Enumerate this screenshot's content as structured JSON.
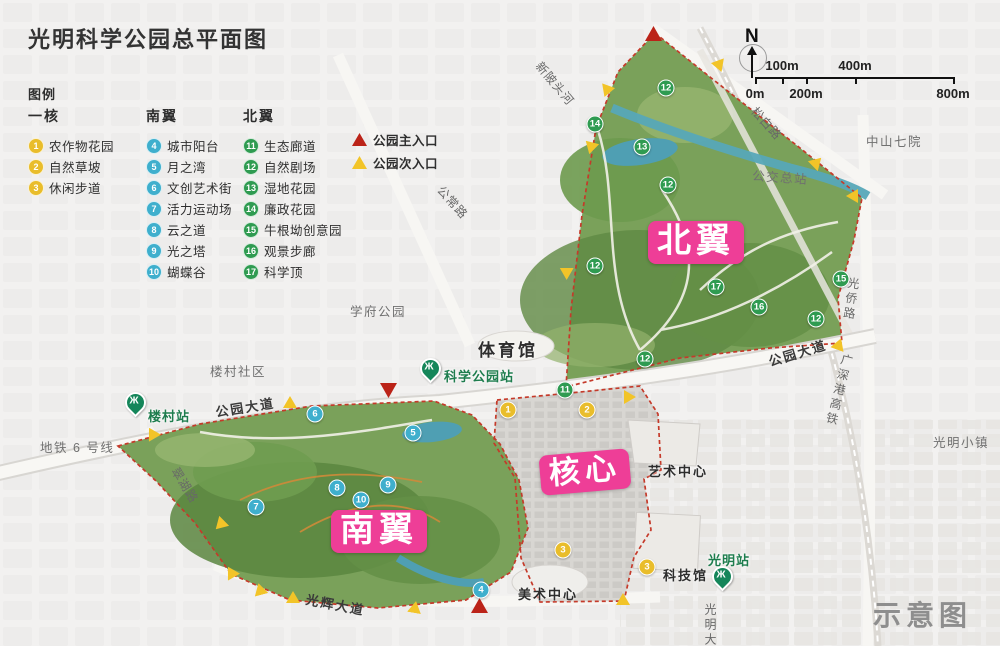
{
  "title": "光明科学公园总平面图",
  "watermark": "示意图",
  "colors": {
    "core": "#e9bd2b",
    "south": "#3fafcd",
    "north": "#2f9b51",
    "main_entrance": "#bb2318",
    "secondary_entrance": "#f2c428",
    "zone_label_bg": "#ee3e97",
    "station_green": "#15865a"
  },
  "legend": {
    "heading": "图例",
    "groups": [
      {
        "name": "一核",
        "group": "core",
        "color": "#e9bd2b",
        "x": 0,
        "items": [
          {
            "num": "1",
            "label": "农作物花园"
          },
          {
            "num": "2",
            "label": "自然草坡"
          },
          {
            "num": "3",
            "label": "休闲步道"
          }
        ]
      },
      {
        "name": "南翼",
        "group": "south",
        "color": "#3fafcd",
        "x": 118,
        "items": [
          {
            "num": "4",
            "label": "城市阳台"
          },
          {
            "num": "5",
            "label": "月之湾"
          },
          {
            "num": "6",
            "label": "文创艺术街"
          },
          {
            "num": "7",
            "label": "活力运动场"
          },
          {
            "num": "8",
            "label": "云之道"
          },
          {
            "num": "9",
            "label": "光之塔"
          },
          {
            "num": "10",
            "label": "蝴蝶谷"
          }
        ]
      },
      {
        "name": "北翼",
        "group": "north",
        "color": "#2f9b51",
        "x": 215,
        "items": [
          {
            "num": "11",
            "label": "生态廊道"
          },
          {
            "num": "12",
            "label": "自然剧场"
          },
          {
            "num": "13",
            "label": "湿地花园"
          },
          {
            "num": "14",
            "label": "廉政花园"
          },
          {
            "num": "15",
            "label": "牛根坳创意园"
          },
          {
            "num": "16",
            "label": "观景步廊"
          },
          {
            "num": "17",
            "label": "科学顶"
          }
        ]
      }
    ],
    "entrances": [
      {
        "type": "main",
        "label": "公园主入口",
        "color": "#bb2318"
      },
      {
        "type": "secondary",
        "label": "公园次入口",
        "color": "#f2c428"
      }
    ]
  },
  "compass": {
    "north_label": "N"
  },
  "scalebar": {
    "ticks": [
      {
        "label": "0m",
        "x": 755,
        "side": "below"
      },
      {
        "label": "100m",
        "x": 782,
        "side": "above"
      },
      {
        "label": "200m",
        "x": 806,
        "side": "below"
      },
      {
        "label": "400m",
        "x": 855,
        "side": "above"
      },
      {
        "label": "800m",
        "x": 953,
        "side": "below"
      }
    ]
  },
  "map": {
    "zones": [
      {
        "id": "north-wing",
        "label": "北翼",
        "x": 648,
        "y": 221,
        "fs": 34,
        "rot": 0
      },
      {
        "id": "core",
        "label": "核心",
        "x": 540,
        "y": 452,
        "fs": 31,
        "rot": -5
      },
      {
        "id": "south-wing",
        "label": "南翼",
        "x": 331,
        "y": 510,
        "fs": 34,
        "rot": 0
      }
    ],
    "stations": [
      {
        "name": "楼村站",
        "px": 125,
        "py": 392,
        "lx": 148,
        "ly": 406
      },
      {
        "name": "科学公园站",
        "px": 420,
        "py": 358,
        "lx": 444,
        "ly": 366
      },
      {
        "name": "光明站",
        "px": 712,
        "py": 566,
        "lx": 708,
        "ly": 550
      }
    ],
    "places": [
      {
        "text": "新陂头河",
        "x": 545,
        "y": 58,
        "rot": 50,
        "cls": "road"
      },
      {
        "text": "松白路",
        "x": 760,
        "y": 103,
        "rot": 48,
        "cls": "road"
      },
      {
        "text": "中山七院",
        "x": 866,
        "y": 131,
        "rot": 0,
        "cls": "area"
      },
      {
        "text": "公交总站",
        "x": 753,
        "y": 165,
        "rot": 4,
        "cls": "area"
      },
      {
        "text": "公常路",
        "x": 446,
        "y": 182,
        "rot": 48,
        "cls": "road"
      },
      {
        "text": "光侨路",
        "x": 846,
        "y": 276,
        "rot": 8,
        "cls": "road vert"
      },
      {
        "text": "学府公园",
        "x": 350,
        "y": 301,
        "rot": 0,
        "cls": "area"
      },
      {
        "text": "公园大道",
        "x": 766,
        "y": 352,
        "rot": -17,
        "cls": "road-dark"
      },
      {
        "text": "广深港高铁",
        "x": 840,
        "y": 352,
        "rot": 14,
        "cls": "road vert"
      },
      {
        "text": "楼村社区",
        "x": 210,
        "y": 361,
        "rot": 0,
        "cls": "area"
      },
      {
        "text": "公园大道",
        "x": 214,
        "y": 402,
        "rot": -9,
        "cls": "road-dark"
      },
      {
        "text": "光明小镇",
        "x": 933,
        "y": 432,
        "rot": 0,
        "cls": "area"
      },
      {
        "text": "地铁 6 号线",
        "x": 40,
        "y": 437,
        "rot": 0,
        "cls": "area"
      },
      {
        "text": "翠湖路",
        "x": 182,
        "y": 464,
        "rot": 58,
        "cls": "road"
      },
      {
        "text": "光辉大道",
        "x": 308,
        "y": 589,
        "rot": 11,
        "cls": "road-dark"
      },
      {
        "text": "光明大道",
        "x": 702,
        "y": 603,
        "rot": 0,
        "cls": "road vert"
      },
      {
        "text": "体育馆",
        "x": 478,
        "y": 336,
        "rot": 0,
        "cls": "building-lg"
      },
      {
        "text": "艺术中心",
        "x": 648,
        "y": 461,
        "rot": 0,
        "cls": "building"
      },
      {
        "text": "科技馆",
        "x": 663,
        "y": 565,
        "rot": 0,
        "cls": "building"
      },
      {
        "text": "美术中心",
        "x": 518,
        "y": 584,
        "rot": 0,
        "cls": "building"
      }
    ],
    "markers": [
      {
        "num": "12",
        "group": "north",
        "x": 666,
        "y": 88
      },
      {
        "num": "14",
        "group": "north",
        "x": 595,
        "y": 124
      },
      {
        "num": "13",
        "group": "north",
        "x": 642,
        "y": 147
      },
      {
        "num": "12",
        "group": "north",
        "x": 668,
        "y": 185
      },
      {
        "num": "12",
        "group": "north",
        "x": 595,
        "y": 266
      },
      {
        "num": "15",
        "group": "north",
        "x": 841,
        "y": 279
      },
      {
        "num": "17",
        "group": "north",
        "x": 716,
        "y": 287
      },
      {
        "num": "16",
        "group": "north",
        "x": 759,
        "y": 307
      },
      {
        "num": "12",
        "group": "north",
        "x": 816,
        "y": 319
      },
      {
        "num": "12",
        "group": "north",
        "x": 645,
        "y": 359
      },
      {
        "num": "11",
        "group": "north",
        "x": 565,
        "y": 390
      },
      {
        "num": "1",
        "group": "core",
        "x": 508,
        "y": 410
      },
      {
        "num": "2",
        "group": "core",
        "x": 587,
        "y": 410
      },
      {
        "num": "3",
        "group": "core",
        "x": 563,
        "y": 550
      },
      {
        "num": "3",
        "group": "core",
        "x": 647,
        "y": 567
      },
      {
        "num": "6",
        "group": "south",
        "x": 315,
        "y": 414
      },
      {
        "num": "5",
        "group": "south",
        "x": 413,
        "y": 433
      },
      {
        "num": "9",
        "group": "south",
        "x": 388,
        "y": 485
      },
      {
        "num": "8",
        "group": "south",
        "x": 337,
        "y": 488
      },
      {
        "num": "10",
        "group": "south",
        "x": 361,
        "y": 500
      },
      {
        "num": "7",
        "group": "south",
        "x": 256,
        "y": 507
      },
      {
        "num": "4",
        "group": "south",
        "x": 481,
        "y": 590
      }
    ],
    "entrance_markers": [
      {
        "type": "main",
        "x": 645,
        "y": 26,
        "rot": 0
      },
      {
        "type": "main",
        "x": 380,
        "y": 383,
        "rot": 180
      },
      {
        "type": "main",
        "x": 471,
        "y": 598,
        "rot": 0
      },
      {
        "type": "secondary",
        "x": 599,
        "y": 82,
        "rot": -40
      },
      {
        "type": "secondary",
        "x": 713,
        "y": 57,
        "rot": 40
      },
      {
        "type": "secondary",
        "x": 583,
        "y": 139,
        "rot": -45
      },
      {
        "type": "secondary",
        "x": 810,
        "y": 156,
        "rot": 45
      },
      {
        "type": "secondary",
        "x": 845,
        "y": 190,
        "rot": -90
      },
      {
        "type": "secondary",
        "x": 558,
        "y": 265,
        "rot": -60
      },
      {
        "type": "secondary",
        "x": 832,
        "y": 338,
        "rot": 20
      },
      {
        "type": "secondary",
        "x": 623,
        "y": 391,
        "rot": 90
      },
      {
        "type": "secondary",
        "x": 283,
        "y": 396,
        "rot": 0
      },
      {
        "type": "secondary",
        "x": 145,
        "y": 427,
        "rot": -30
      },
      {
        "type": "secondary",
        "x": 213,
        "y": 519,
        "rot": 225
      },
      {
        "type": "secondary",
        "x": 224,
        "y": 566,
        "rot": -30
      },
      {
        "type": "secondary",
        "x": 253,
        "y": 583,
        "rot": -15
      },
      {
        "type": "secondary",
        "x": 286,
        "y": 591,
        "rot": 0
      },
      {
        "type": "secondary",
        "x": 408,
        "y": 601,
        "rot": 10
      },
      {
        "type": "secondary",
        "x": 616,
        "y": 593,
        "rot": 0
      }
    ]
  }
}
